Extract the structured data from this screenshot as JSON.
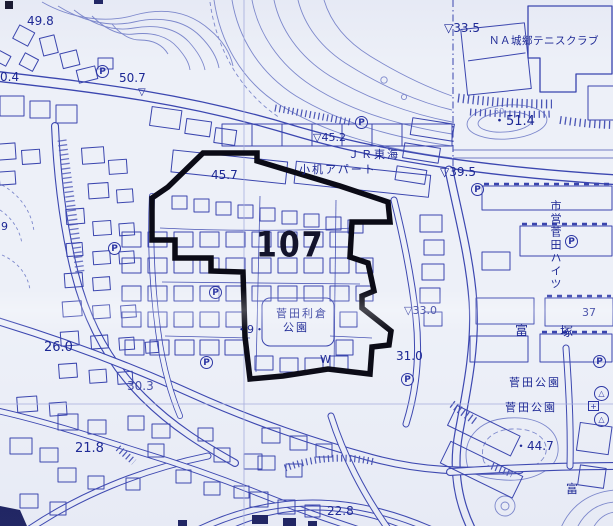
{
  "district_number": "107",
  "symbols": {
    "parking": "P",
    "benchmark": "▽",
    "monument": "△",
    "plus": "+"
  },
  "labels": {
    "spot_49_8": "49.8",
    "spot_50_4_partial": "0.4",
    "spot_50_7": "50.7",
    "bm_45_2": "▽45.2",
    "jr_tokai": "ＪＲ東海",
    "kozukue_apart": "小机アパート",
    "spot_45_7": "45.7",
    "bm_33_5": "▽33.5",
    "tennis_club": "ＮＡ城郷テニスクラブ",
    "contour_50": "50",
    "spot_51_4": "・51.4",
    "bm_39_5": "▽39.5",
    "shiei_sugeta_heights": "市営菅田ハイツ",
    "tomi": "富",
    "tsuka": "塚",
    "spot_37": "37",
    "bm_33_0": "▽33.0",
    "spot_31_0": "31.0",
    "spot_9": "・9・",
    "park_toshikura_line1": "菅田利倉",
    "park_toshikura_line2": "公園",
    "w_mark": "W",
    "spot_26_0": "26.0",
    "spot_30_3": "30.3",
    "spot_21_8": "21.8",
    "spot_22_8": "22.8",
    "sugeta_park_upper": "菅田公園",
    "sugeta_park_lower": "菅田公園",
    "spot_44_7": "・44.7",
    "tomi_lower": "富",
    "spot_9_left": "9"
  },
  "colors": {
    "paper": "#edf0f8",
    "line_blue": "#3a45ae",
    "contour_blue": "#7d88cc",
    "label_navy": "#1c2794",
    "boundary_black": "#0b0b16"
  }
}
